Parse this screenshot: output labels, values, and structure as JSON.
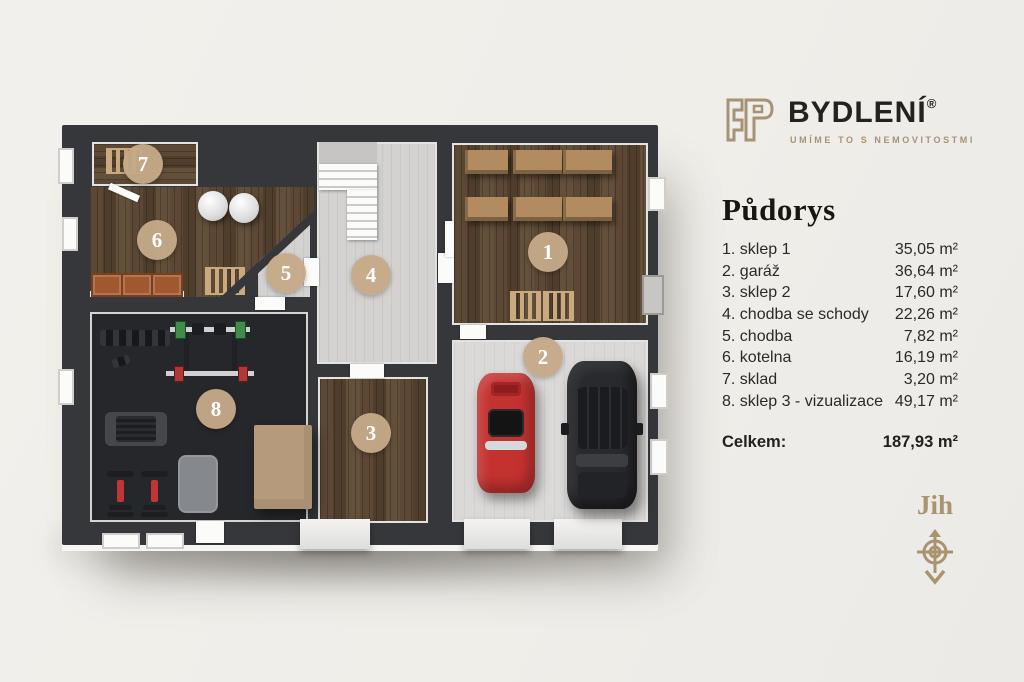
{
  "logo": {
    "brand": "BYDLENÍ",
    "registered": "®",
    "tagline": "UMÍME TO S NEMOVITOSTMI"
  },
  "panel": {
    "title": "Půdorys",
    "total_label": "Celkem:",
    "total_value": "187,93 m²",
    "compass_label": "Jih"
  },
  "legend": {
    "items": [
      {
        "label": "1. sklep 1",
        "area": "35,05 m²"
      },
      {
        "label": "2. garáž",
        "area": "36,64 m²"
      },
      {
        "label": "3. sklep 2",
        "area": "17,60 m²"
      },
      {
        "label": "4. chodba se schody",
        "area": "22,26 m²"
      },
      {
        "label": "5. chodba",
        "area": "7,82 m²"
      },
      {
        "label": "6. kotelna",
        "area": "16,19 m²"
      },
      {
        "label": "7. sklad",
        "area": "3,20 m²"
      },
      {
        "label": "8. sklep 3 - vizualizace",
        "area": "49,17 m²"
      }
    ]
  },
  "plan": {
    "rooms": [
      {
        "number": "1",
        "name": "sklep 1"
      },
      {
        "number": "2",
        "name": "garáž"
      },
      {
        "number": "3",
        "name": "sklep 2"
      },
      {
        "number": "4",
        "name": "chodba se schody"
      },
      {
        "number": "5",
        "name": "chodba"
      },
      {
        "number": "6",
        "name": "kotelna"
      },
      {
        "number": "7",
        "name": "sklad"
      },
      {
        "number": "8",
        "name": "sklep 3 - vizualizace"
      }
    ]
  },
  "colors": {
    "accent_tan": "#a8946f",
    "wall": "#36373b",
    "circle": "#c5aa88",
    "background": "#f0eee9"
  }
}
